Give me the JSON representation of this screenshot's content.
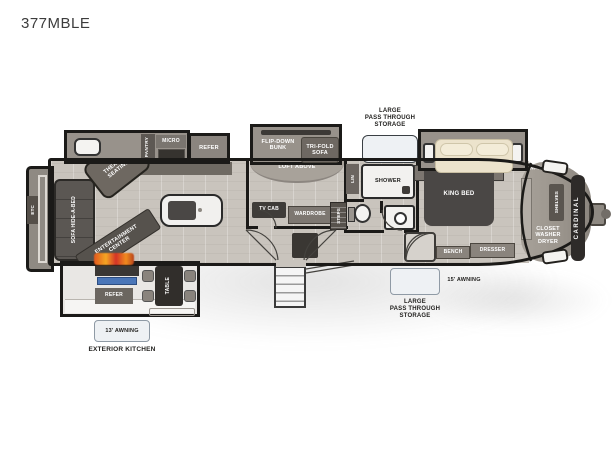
{
  "title": "377MBLE",
  "colors": {
    "wall": "#1b1a18",
    "floor": "#c9c4bd",
    "slide": "#98928b",
    "furniture_dark": "#4a4745",
    "flame_accent": "#f08c1e",
    "griddle_blue": "#4a76b8",
    "callout_box": "#eef1f4"
  },
  "coach": {
    "brand_vertical": "CARDINAL",
    "rear_wall": "ETC"
  },
  "living": {
    "sofa": "SOFA HIDE-A-BED",
    "theater": [
      "THEATER",
      "SEATING"
    ],
    "entertainment": [
      "ENTERTAINMENT",
      "CENTER"
    ]
  },
  "kitchen": {
    "pantry": "PANTRY",
    "micro": "MICRO",
    "refer": "REFER"
  },
  "bunk_room": {
    "flip_down_bunk": [
      "FLIP-DOWN",
      "BUNK"
    ],
    "tri_fold_sofa": [
      "TRI-FOLD",
      "SOFA"
    ],
    "loft": "LOFT ABOVE",
    "tv_cab": "TV CAB",
    "wardrobe": "WARDROBE",
    "steps": "STEPS"
  },
  "bath": {
    "linen": "LIN",
    "shower": "SHOWER"
  },
  "bedroom": {
    "king_bed": "KING BED",
    "bench": "BENCH",
    "dresser": "DRESSER"
  },
  "closet": {
    "wardrobe": "WARDROBE",
    "shelves": "SHELVES",
    "washer_dryer": [
      "CLOSET",
      "WASHER",
      "DRYER"
    ]
  },
  "exterior": {
    "storage_top": [
      "LARGE",
      "PASS THROUGH",
      "STORAGE"
    ],
    "storage_bottom": [
      "LARGE",
      "PASS THROUGH",
      "STORAGE"
    ],
    "awning_rear": "13' AWNING",
    "awning_front": "15' AWNING",
    "exterior_kitchen": "EXTERIOR KITCHEN",
    "outdoor_refer": "REFER",
    "outdoor_table": "TABLE"
  }
}
